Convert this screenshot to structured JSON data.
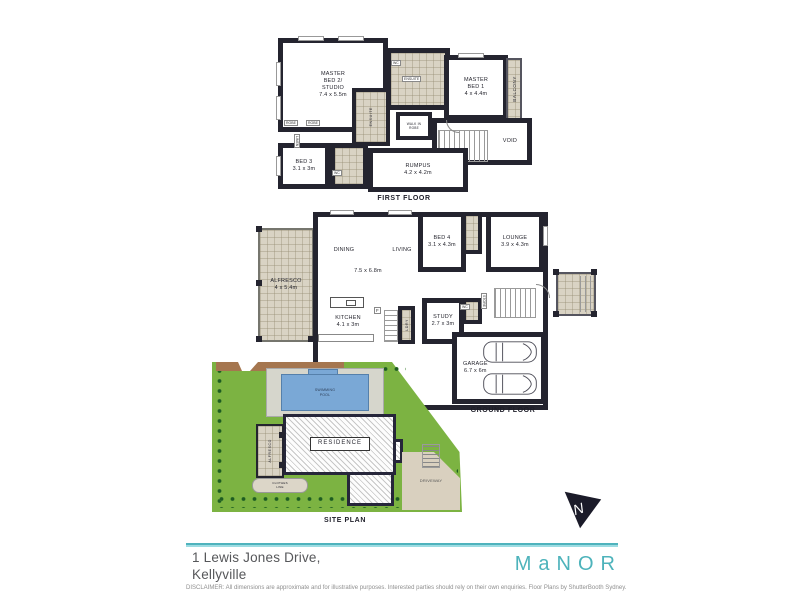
{
  "colors": {
    "wall": "#24242f",
    "tile": "#d9d3c4",
    "lawn": "#7cb342",
    "pool": "#7aa8d6",
    "brand_teal": "#4db3bb",
    "brown_wall": "#a5764f"
  },
  "first_floor": {
    "caption": "FIRST FLOOR",
    "master_bed2": "MASTER\nBED 2/\nSTUDIO\n7.4 x 5.5m",
    "master_bed1": "MASTER\nBED 1\n4 x 4.4m",
    "balcony": "BALCONY",
    "ensuite_top": "ENSUITE",
    "ensuite_mid": "ENSUITE",
    "walk_in_robe": "WALK IN\nROBE",
    "void": "VOID",
    "rumpus": "RUMPUS\n4.2 x 4.2m",
    "bed3": "BED 3\n3.1 x 3m",
    "robe": "ROBE",
    "linen": "LINEN",
    "wc": "WC"
  },
  "ground_floor": {
    "caption": "GROUND FLOOR",
    "alfresco": "ALFRESCO\n4 x 5.4m",
    "dining": "DINING",
    "living": "LIVING",
    "living_dim": "7.5 x 6.8m",
    "bed4": "BED 4\n3.1 x 4.3m",
    "lounge": "LOUNGE\n3.9 x 4.3m",
    "kitchen": "KITCHEN\n4.1 x 3m",
    "study": "STUDY\n2.7 x 3m",
    "garage": "GARAGE\n6.7 x 6m",
    "laundry": "LDRY",
    "store": "STORE",
    "wc": "WC",
    "fridge": "F"
  },
  "site_plan": {
    "caption": "SITE PLAN",
    "pool": "SWIMMING\nPOOL",
    "residence": "RESIDENCE",
    "alfresco": "ALFRESCO",
    "driveway": "DRIVEWAY",
    "clothes_line": "CLOTHES\nLINE"
  },
  "footer": {
    "address_line1": "1 Lewis Jones Drive,",
    "address_line2": "Kellyville",
    "brand": "MaNOR",
    "disclaimer": "DISCLAIMER: All dimensions are approximate and for illustrative purposes. Interested parties should rely on their own enquiries. Floor Plans by ShutterBooth Sydney."
  }
}
